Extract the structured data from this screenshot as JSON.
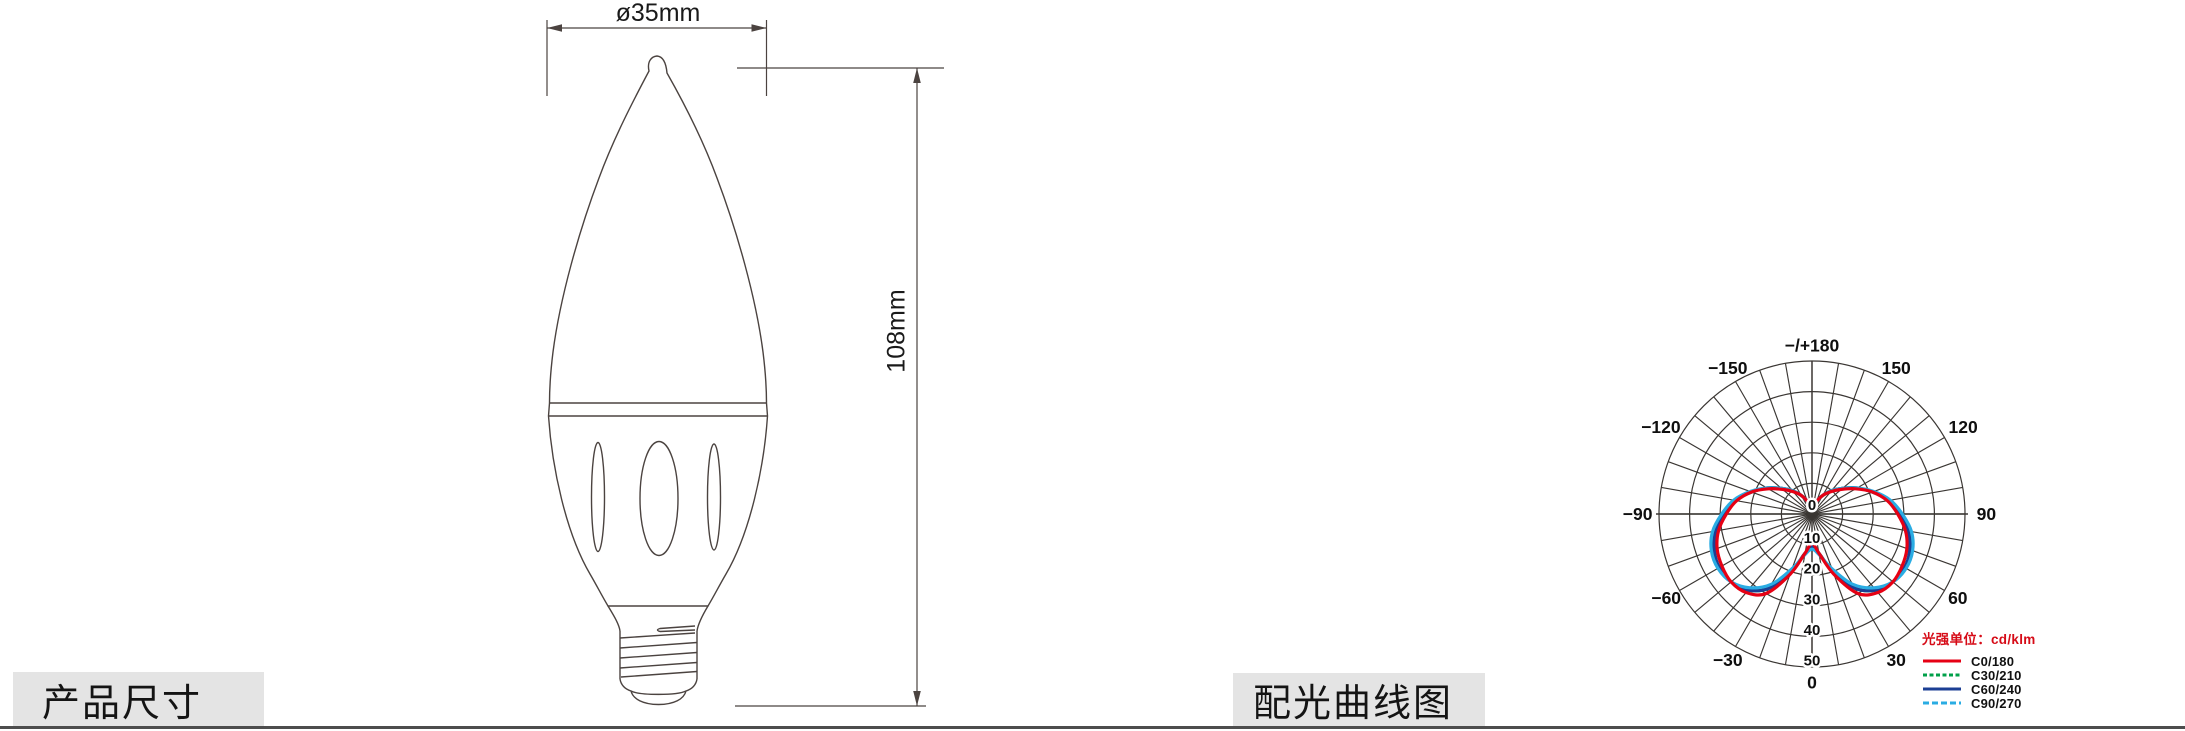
{
  "page": {
    "background": "#ffffff"
  },
  "product_dimensions": {
    "section_label": "产品尺寸",
    "diameter_label": "ø35mm",
    "height_label": "108mm"
  },
  "light_distribution": {
    "section_label": "配光曲线图"
  },
  "chart_data": {
    "type": "polar",
    "subtype": "light-distribution-curve",
    "unit_label": "光强单位：cd/klm",
    "unit_label_color": "#d60b17",
    "r_max": 50,
    "r_ticks": [
      0,
      10,
      20,
      30,
      40,
      50
    ],
    "grid_step_deg": 10,
    "angle_label_step_deg": 30,
    "angle_labels": [
      {
        "text": "0",
        "deg": 0
      },
      {
        "text": "30",
        "deg": 30
      },
      {
        "text": "60",
        "deg": 60
      },
      {
        "text": "90",
        "deg": 90
      },
      {
        "text": "120",
        "deg": 120
      },
      {
        "text": "150",
        "deg": 150
      },
      {
        "text": "−/+180",
        "deg": 180
      },
      {
        "text": "−150",
        "deg": -150
      },
      {
        "text": "−120",
        "deg": -120
      },
      {
        "text": "−90",
        "deg": -90
      },
      {
        "text": "−60",
        "deg": -60
      },
      {
        "text": "−30",
        "deg": -30
      }
    ],
    "angles_deg": [
      0,
      10,
      20,
      30,
      40,
      50,
      60,
      70,
      80,
      90,
      100,
      110,
      120,
      130,
      140,
      150,
      160,
      170,
      180
    ],
    "symmetric": true,
    "series": [
      {
        "name": "C0/180",
        "color": "#e60014",
        "dash": null,
        "legend_dash": null,
        "values": [
          9.5,
          13,
          21,
          30,
          33.5,
          34.5,
          34,
          33,
          31,
          28,
          25,
          21,
          16.5,
          12.5,
          9.5,
          7,
          4.5,
          2.5,
          1
        ]
      },
      {
        "name": "C30/210",
        "color": "#00a04a",
        "dash": null,
        "legend_dash": "4,2.5",
        "values": [
          10.5,
          13,
          20,
          28,
          32.5,
          34.5,
          35,
          34,
          32,
          29,
          25.5,
          21,
          17,
          13,
          10,
          7,
          4.5,
          2.5,
          1
        ]
      },
      {
        "name": "C60/240",
        "color": "#1c3f94",
        "dash": null,
        "legend_dash": null,
        "values": [
          10.5,
          13,
          20,
          28,
          32.5,
          34.5,
          35,
          34,
          32,
          29,
          25.5,
          21,
          17,
          13,
          10,
          7,
          4.5,
          2.5,
          1
        ]
      },
      {
        "name": "C90/270",
        "color": "#2aace3",
        "dash": null,
        "legend_dash": "6,3",
        "values": [
          11.5,
          13.5,
          19,
          26.5,
          31.5,
          34.5,
          35.5,
          35,
          33,
          29.5,
          26,
          21.5,
          17,
          13,
          10,
          7,
          4.5,
          2.5,
          1
        ]
      }
    ],
    "grid_color": "#3a3633",
    "draw_order": [
      1,
      2,
      3,
      0
    ]
  }
}
